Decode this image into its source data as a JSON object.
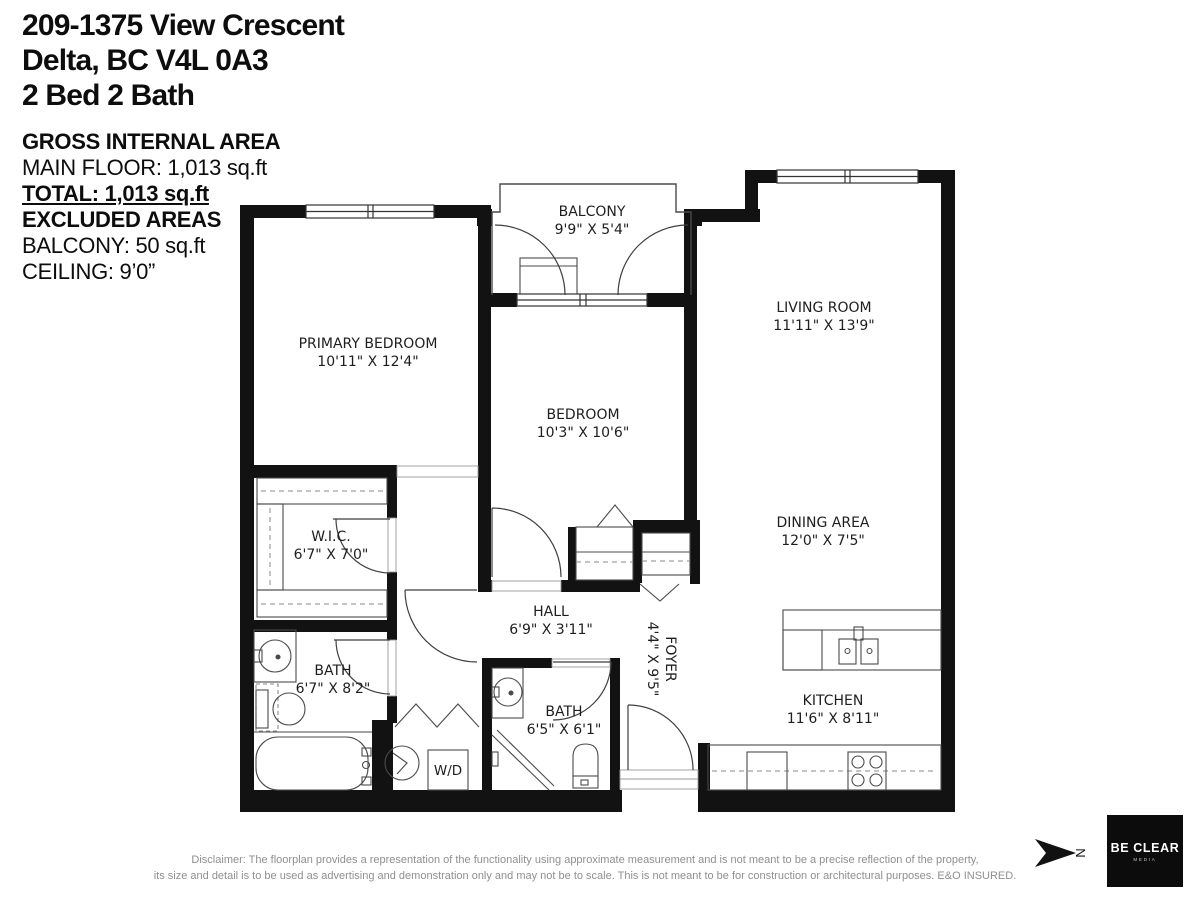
{
  "header": {
    "address_line1": "209-1375 View Crescent",
    "address_line2": "Delta, BC V4L 0A3",
    "address_line3": "2 Bed 2 Bath"
  },
  "area_summary": {
    "gross_heading": "GROSS INTERNAL AREA",
    "main_floor": "MAIN FLOOR: 1,013 sq.ft",
    "total": "TOTAL: 1,013 sq.ft",
    "excluded_heading": "EXCLUDED AREAS",
    "balcony": "BALCONY: 50 sq.ft",
    "ceiling": "CEILING: 9’0”"
  },
  "rooms": [
    {
      "name": "BALCONY",
      "dims": "9'9\" X 5'4\""
    },
    {
      "name": "PRIMARY BEDROOM",
      "dims": "10'11\" X 12'4\""
    },
    {
      "name": "LIVING ROOM",
      "dims": "11'11\" X 13'9\""
    },
    {
      "name": "BEDROOM",
      "dims": "10'3\" X 10'6\""
    },
    {
      "name": "W.I.C.",
      "dims": "6'7\" X 7'0\""
    },
    {
      "name": "DINING AREA",
      "dims": "12'0\" X 7'5\""
    },
    {
      "name": "HALL",
      "dims": "6'9\" X 3'11\""
    },
    {
      "name": "FOYER",
      "dims": "4'4\" X 9'5\""
    },
    {
      "name": "BATH",
      "dims": "6'7\" X 8'2\""
    },
    {
      "name": "BATH",
      "dims": "6'5\" X 6'1\""
    },
    {
      "name": "KITCHEN",
      "dims": "11'6\" X 8'11\""
    }
  ],
  "fixtures": {
    "washer_dryer": "W/D"
  },
  "compass": {
    "north": "N"
  },
  "footer": {
    "disclaimer_line1": "Disclaimer: The floorplan provides a representation of the functionality using approximate measurement and is not meant to be a precise reflection of the property,",
    "disclaimer_line2": "its size and detail is to be used as advertising and demonstration only and may not be to scale. This is not meant to be for construction or architectural purposes. E&O INSURED.",
    "logo_name": "BE CLEAR",
    "logo_sub": "MEDIA"
  }
}
